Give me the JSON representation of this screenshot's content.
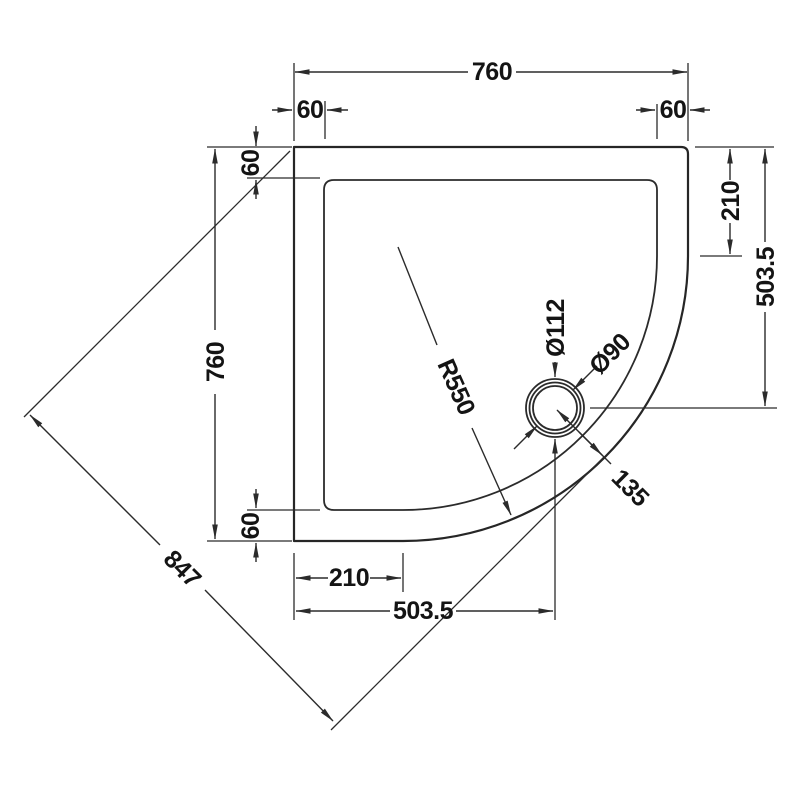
{
  "drawing": {
    "title": "quadrant-shower-tray-plan",
    "colors": {
      "line": "#2b2b2b",
      "text": "#141414",
      "background": "#ffffff"
    },
    "labels": {
      "width_top": "760",
      "ledge_top_left": "60",
      "ledge_top_right": "60",
      "ledge_left_top": "60",
      "height_left": "760",
      "ledge_left_bottom": "60",
      "right_straight_edge": "210",
      "right_to_drain_centre": "503.5",
      "bottom_straight_edge": "210",
      "bottom_to_drain_centre": "503.5",
      "diagonal_overall": "847",
      "front_corner_radius": "R550",
      "drain_outer_diameter": "Ø112",
      "drain_inner_diameter": "Ø90",
      "drain_to_corner": "135"
    }
  }
}
